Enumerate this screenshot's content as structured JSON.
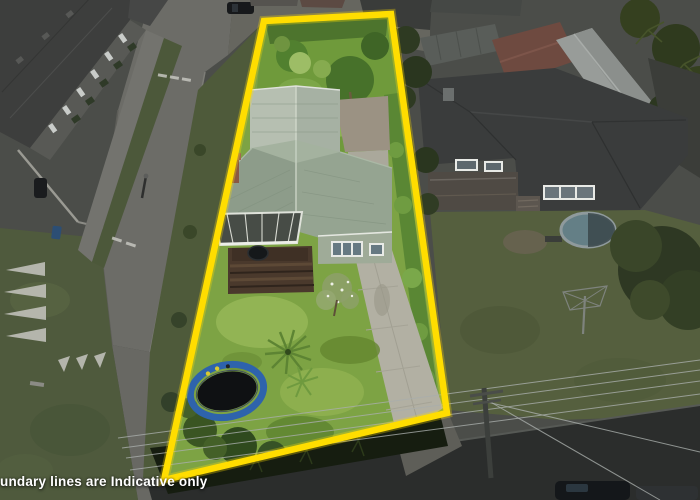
{
  "caption": {
    "text": "undary lines are Indicative only"
  },
  "boundary": {
    "color": "#ffdd00",
    "shape": "quadrilateral",
    "purpose": "indicative property boundary overlay"
  },
  "colors": {
    "lawn": "#7da344",
    "back_garden": "#6f9a3b",
    "roof_main": "#95a491",
    "roof_gable": "#b6bfb1",
    "driveway": "#b2b0a3",
    "trampoline_ring": "#2e63ac",
    "surroundings_desaturated": "#4b4d49",
    "road": "#2b2d2c"
  },
  "scene": {
    "type": "aerial-drone-photo",
    "highlight": "subject property shown in colour inside yellow boundary; surroundings desaturated",
    "subject_property": [
      "back-garden-trees",
      "weatherboard-house",
      "conservatory-glass-roof",
      "brick-chimney",
      "timber-deck-steps",
      "front-lawn",
      "trampoline",
      "cabbage-tree",
      "blossom-tree",
      "concrete-driveway",
      "boundary-hedge"
    ],
    "surroundings": [
      "townhouse-complex",
      "street-with-chevron-markings",
      "street-lamp",
      "recycle-bin",
      "parked-cars",
      "neighbor-house",
      "neighbor-garage-roof",
      "red-shed-roof",
      "palm-trees",
      "above-ground-pool",
      "rotary-clothesline",
      "power-pole",
      "power-lines",
      "bottom-road",
      "dark-hedge"
    ]
  }
}
